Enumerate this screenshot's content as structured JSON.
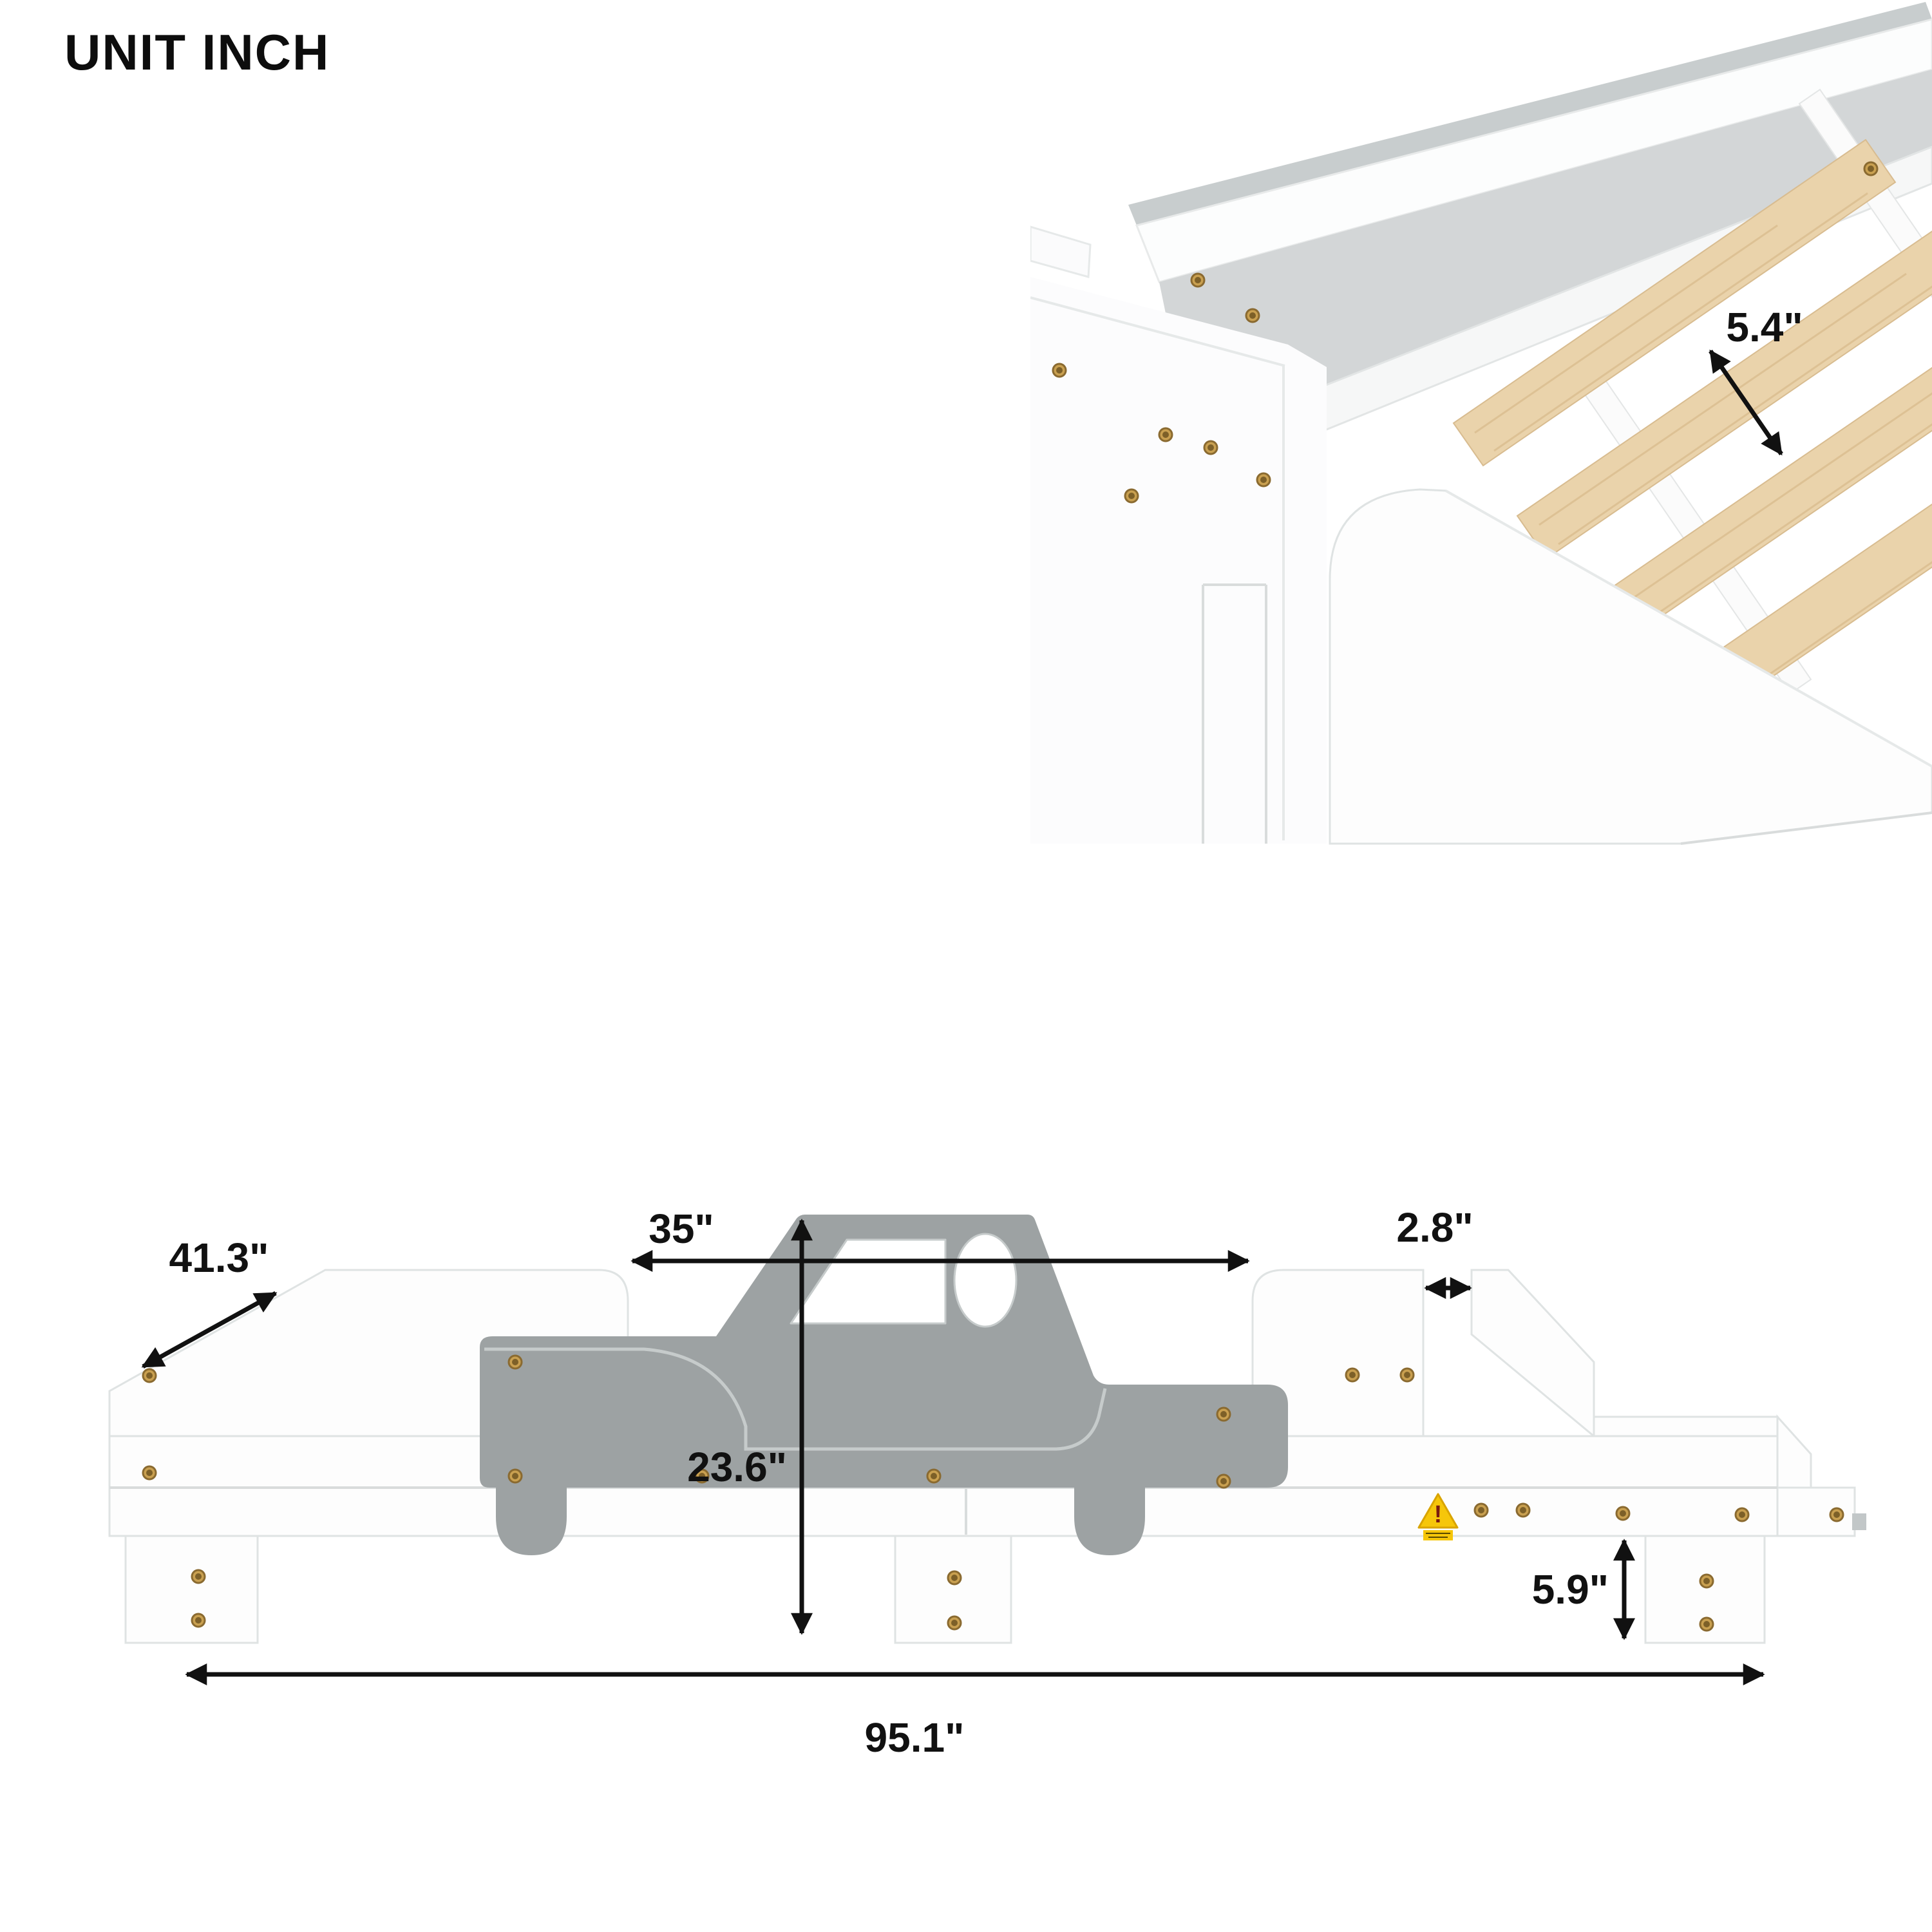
{
  "title": "UNIT INCH",
  "photo": {
    "slat_spacing_label": "5.4\""
  },
  "diagram": {
    "depth_label": "41.3\"",
    "opening_label": "35\"",
    "gap_label": "2.8\"",
    "height_label": "23.6\"",
    "leg_height_label": "5.9\"",
    "length_label": "95.1\"",
    "warning_mark": "!"
  },
  "colors": {
    "background": "#ffffff",
    "car_gray": "#9da2a3",
    "inner_panel_gray": "#d3d6d7",
    "wood_slat": "#ead3ab",
    "warning_yellow": "#f6c60a",
    "hardware_brass": "#c9a050",
    "dimension_ink": "#111111"
  }
}
